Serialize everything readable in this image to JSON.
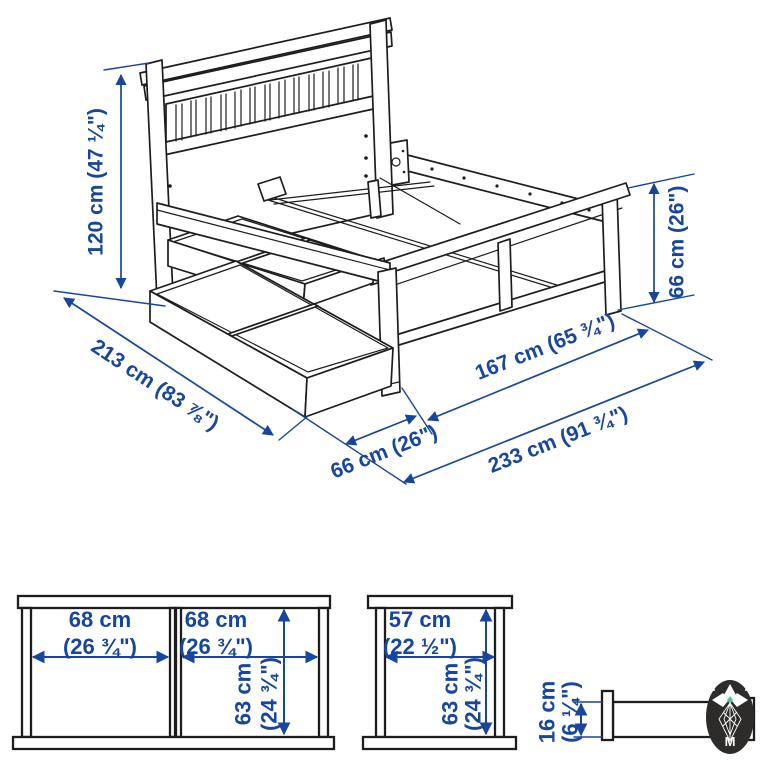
{
  "colors": {
    "dimension_blue": "#17469c",
    "line_black": "#1d1d1d",
    "background": "#ffffff",
    "watermark_bg": "#2d2c2b",
    "watermark_accent": "#55bfa1"
  },
  "iso": {
    "headboard_height": "120 cm (47 ¼\")",
    "bed_length": "213 cm (83 ⅞\")",
    "footboard_height": "66 cm (26\")",
    "drawer_extension": "66 cm (26\")",
    "frame_width": "167 cm (65 ¾\")",
    "total_length": "233 cm (91 ¾\")"
  },
  "front_view": {
    "left_opening_cm": "68 cm",
    "left_opening_in": "(26 ¾\")",
    "right_opening_cm": "68 cm",
    "right_opening_in": "(26 ¾\")",
    "height_cm": "63 cm",
    "height_in": "(24 ¾\")"
  },
  "side_view": {
    "width_cm": "57 cm",
    "width_in": "(22 ½\")",
    "height_cm": "63 cm",
    "height_in": "(24 ¾\")"
  },
  "profile_view": {
    "height_cm": "16 cm",
    "height_in": "(6 ¼\")"
  },
  "watermark": {
    "monogram": "M"
  }
}
